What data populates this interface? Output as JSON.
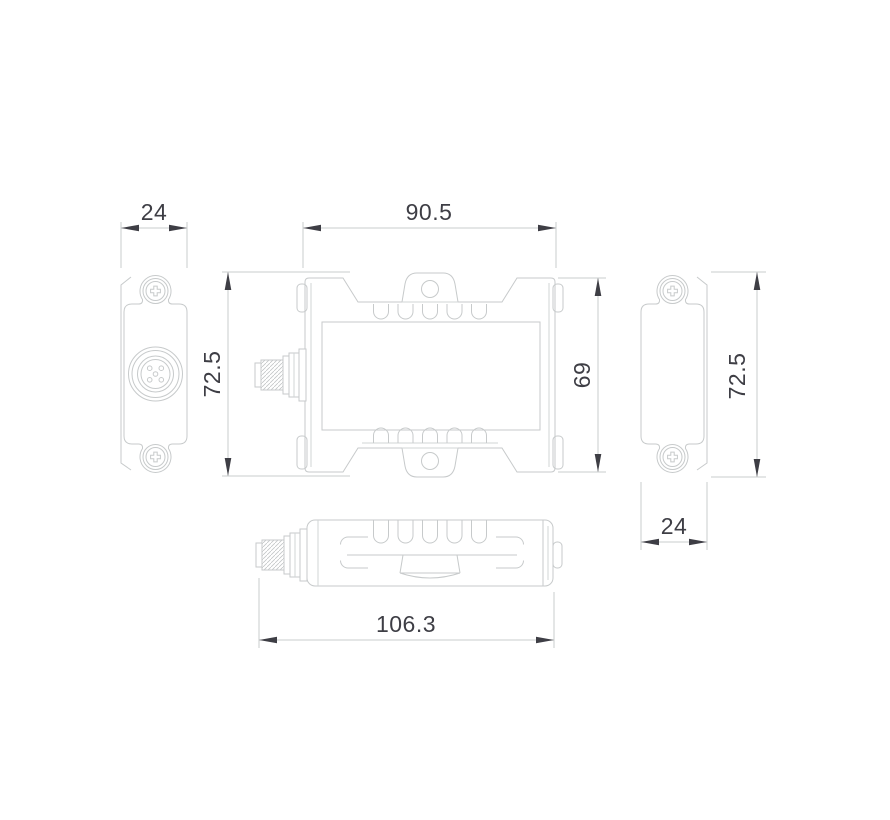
{
  "drawing": {
    "type": "orthographic-dimension-drawing",
    "dimensions": {
      "left_view_width": "24",
      "front_width": "90.5",
      "front_overall_height": "72.5",
      "front_body_height": "69",
      "right_view_height": "72.5",
      "right_view_width": "24",
      "top_view_length": "106.3"
    },
    "colors": {
      "background": "#ffffff",
      "outline": "#c7cacb",
      "dimension_line": "#c9cccd",
      "dimension_text": "#3e3e45",
      "arrowhead": "#3e3e45"
    }
  }
}
